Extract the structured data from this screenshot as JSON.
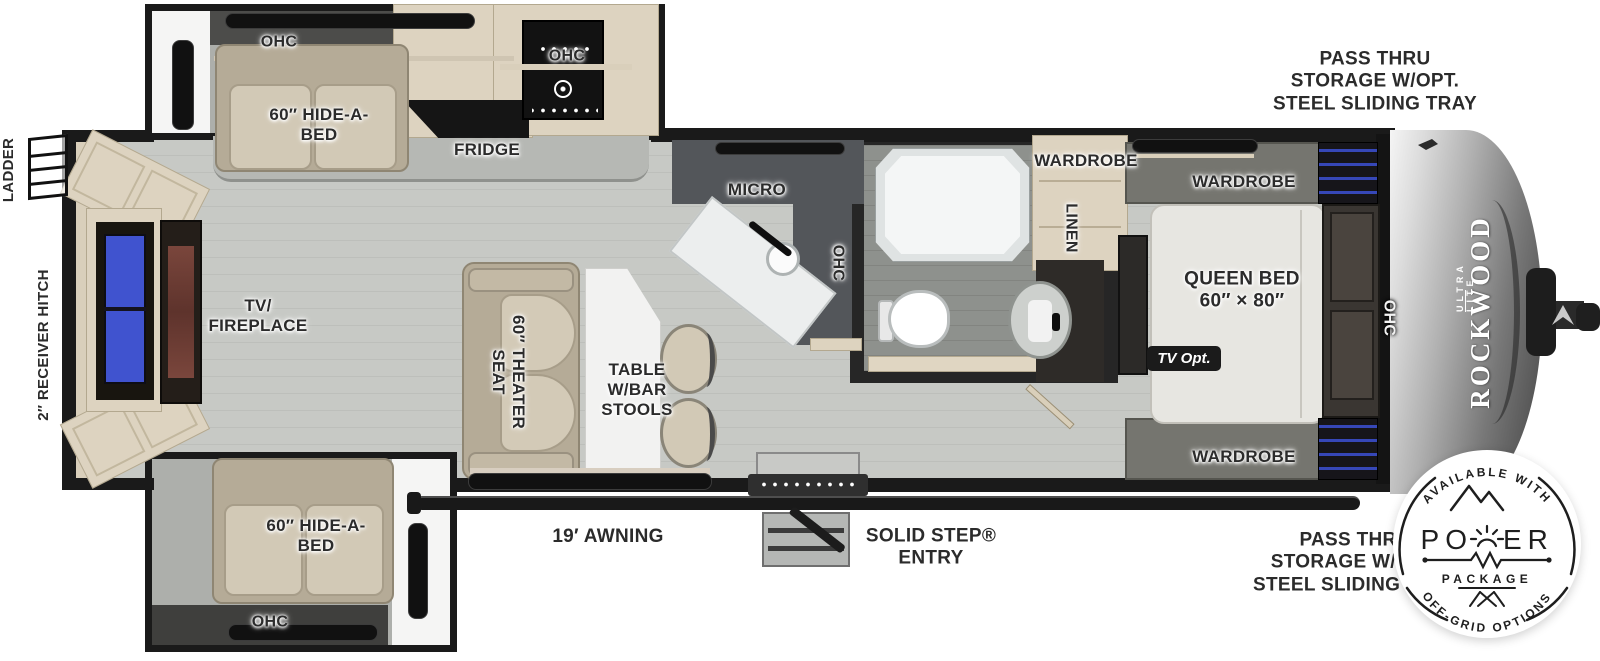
{
  "colors": {
    "wall": "#1a1a1a",
    "floor": "#c7c9c5",
    "slide_floor": "#adafab",
    "cabinet_wood": "#ddd3c0",
    "sofa_beige": "#c9c0ad",
    "counter_dark": "#53565a",
    "bath_floor": "#8e918d",
    "tv_screen_blue": "#4053cf",
    "fireplace_red": "#6e3c34",
    "front_cap_silver": "#9a9a9a",
    "led_accent_blue": "#3647b8"
  },
  "left_side": {
    "ladder": "LADDER",
    "receiver_hitch": "2″ RECEIVER HITCH"
  },
  "top_slide": {
    "ohc": "OHC",
    "hide_a_bed": "60″ HIDE-A-\nBED",
    "fridge": "FRIDGE",
    "ohc_stove": "OHC"
  },
  "kitchen": {
    "micro": "MICRO",
    "ohc": "OHC"
  },
  "living": {
    "tv_fireplace": "TV/\nFIREPLACE",
    "theater_seat": "60″ THEATER\nSEAT",
    "table": "TABLE\nW/BAR\nSTOOLS"
  },
  "bottom_slide": {
    "hide_a_bed": "60″ HIDE-A-\nBED",
    "ohc": "OHC"
  },
  "bathroom": {
    "wardrobe": "WARDROBE",
    "linen": "LINEN"
  },
  "bedroom": {
    "wardrobe_top": "WARDROBE",
    "wardrobe_bottom": "WARDROBE",
    "queen_bed": "QUEEN BED\n60″ × 80″",
    "tv_opt": "TV Opt.",
    "ohc": "OHC"
  },
  "exterior": {
    "pass_thru_top": "PASS THRU\nSTORAGE W/OPT.\nSTEEL SLIDING TRAY",
    "pass_thru_bottom": "PASS THRU\nSTORAGE W/OPT.\nSTEEL SLIDING TRAY",
    "awning": "19′ AWNING",
    "solid_step": "SOLID STEP®\nENTRY"
  },
  "brand": {
    "name": "ROCKWOOD",
    "sub": "ULTRA LITE"
  },
  "badge": {
    "top_text": "AVAILABLE WITH",
    "power_prefix": "PO",
    "power_suffix": "ER",
    "package_text": "PACKAGE",
    "bottom_text": "OFF-GRID OPTIONS"
  }
}
